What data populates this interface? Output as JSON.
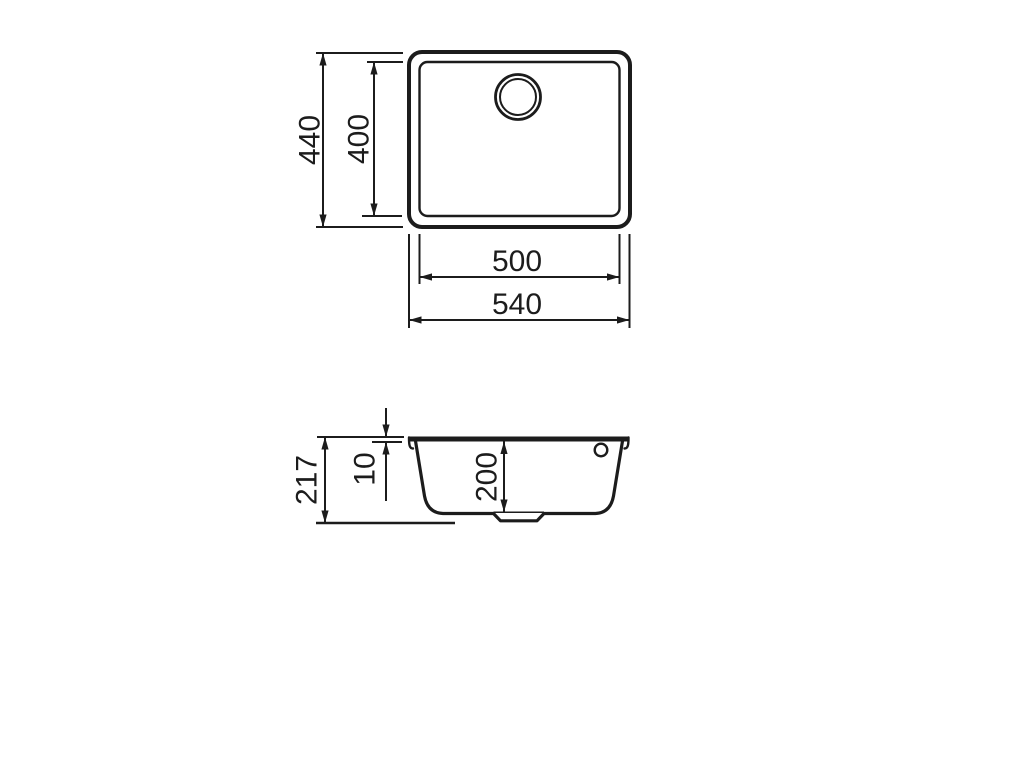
{
  "theme": {
    "background": "#ffffff",
    "line_color": "#1c1c1c",
    "text_color": "#1c1c1c"
  },
  "drawing": {
    "top_view": {
      "outer_height": "440",
      "inner_height": "400",
      "inner_width": "500",
      "outer_width": "540"
    },
    "section_view": {
      "overall_height": "217",
      "rim_thickness": "10",
      "bowl_depth": "200"
    }
  }
}
